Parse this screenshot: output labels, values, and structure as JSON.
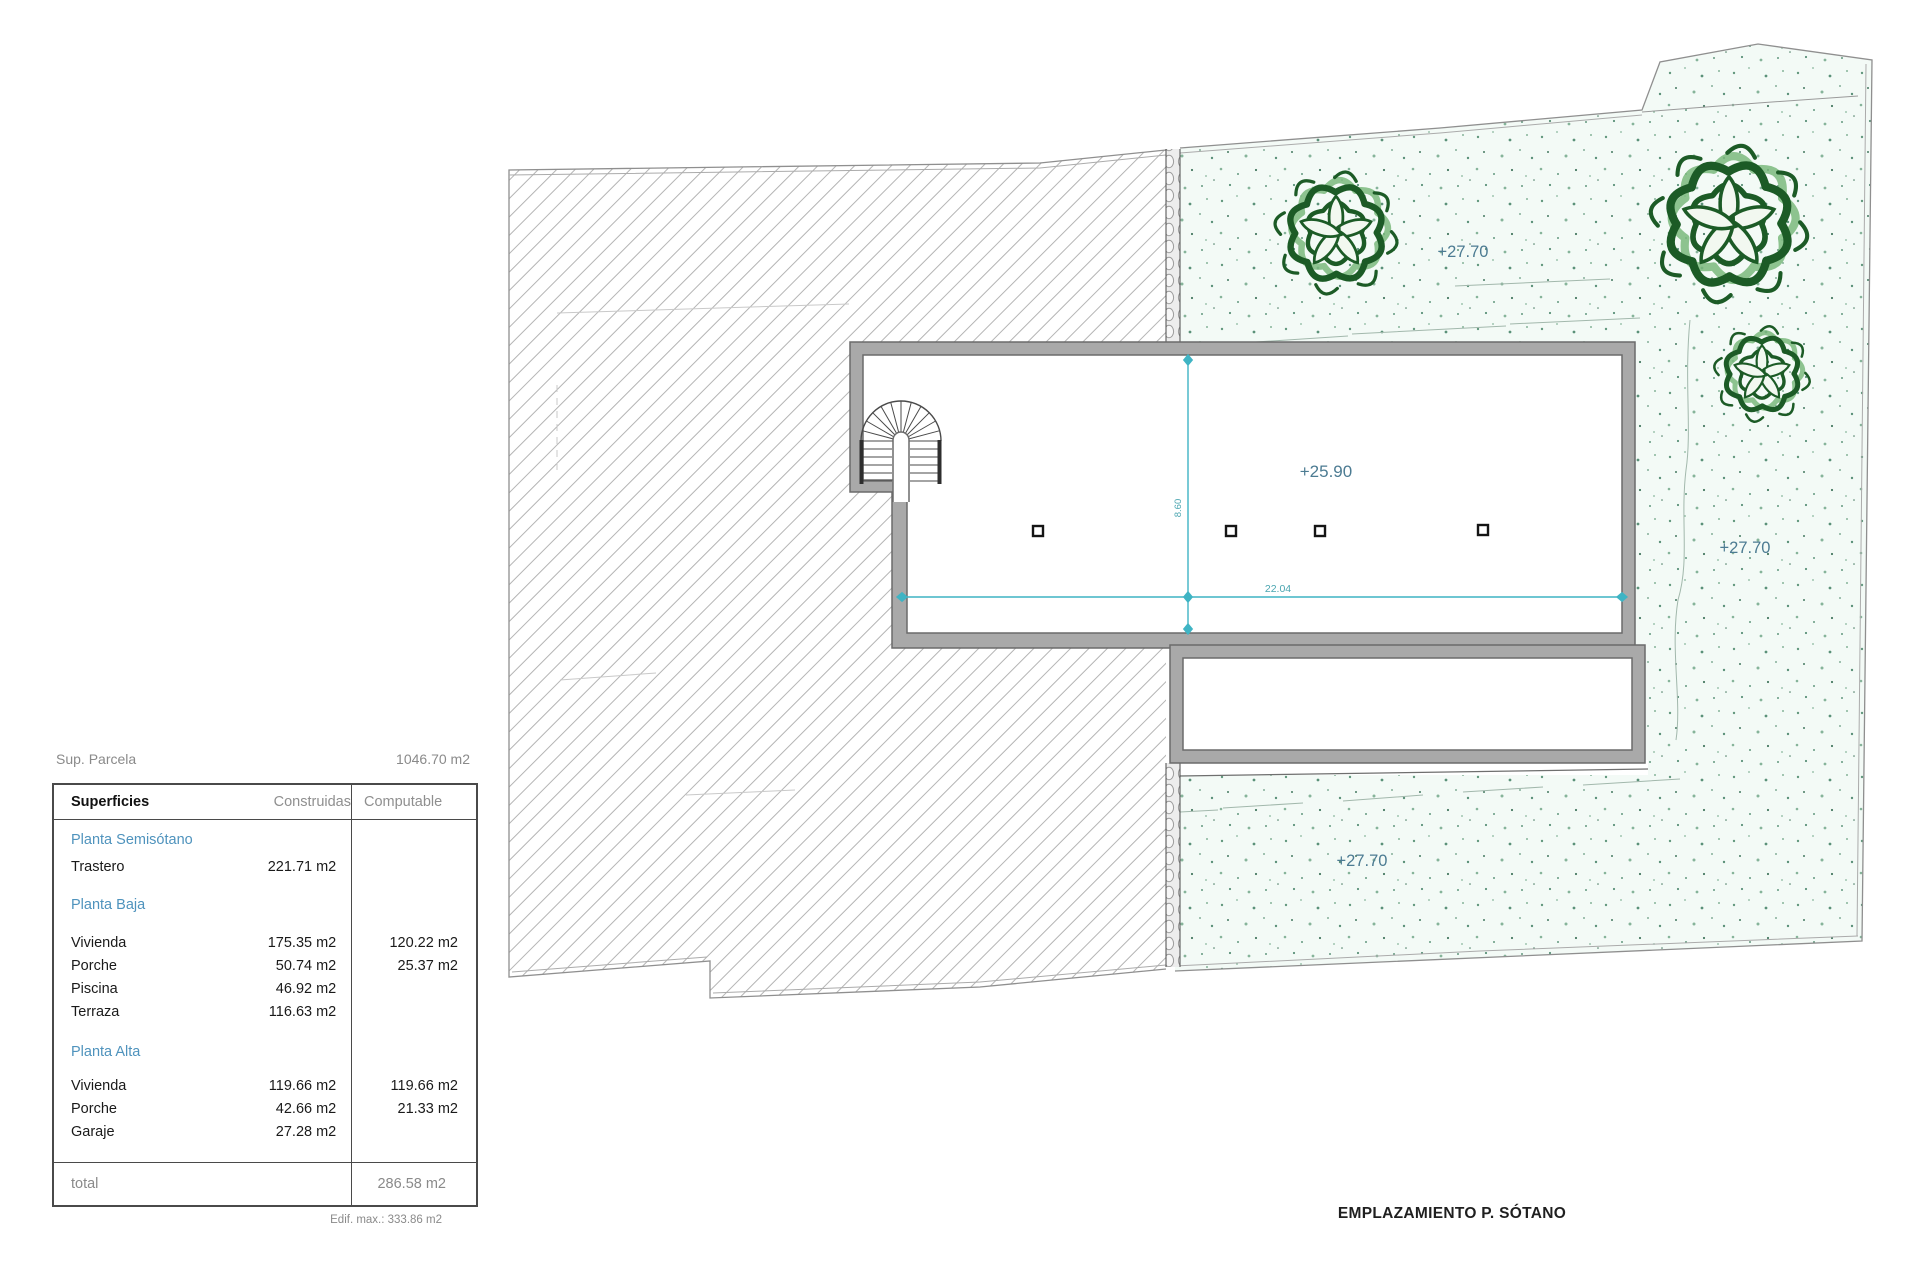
{
  "site_info": {
    "label": "Sup. Parcela",
    "value": "1046.70 m2"
  },
  "table": {
    "headers": {
      "name": "Superficies",
      "built": "Construidas",
      "computable": "Computable"
    },
    "rows": [
      {
        "type": "section",
        "name": "Planta Semisótano"
      },
      {
        "type": "data",
        "name": "Trastero",
        "built": "221.71 m2",
        "comp": ""
      },
      {
        "type": "section",
        "name": "Planta Baja"
      },
      {
        "type": "data",
        "name": "Vivienda",
        "built": "175.35 m2",
        "comp": "120.22 m2"
      },
      {
        "type": "data",
        "name": "Porche",
        "built": "50.74 m2",
        "comp": "25.37 m2"
      },
      {
        "type": "data",
        "name": "Piscina",
        "built": "46.92 m2",
        "comp": ""
      },
      {
        "type": "data",
        "name": "Terraza",
        "built": "116.63 m2",
        "comp": ""
      },
      {
        "type": "section",
        "name": "Planta Alta"
      },
      {
        "type": "data",
        "name": "Vivienda",
        "built": "119.66 m2",
        "comp": "119.66 m2"
      },
      {
        "type": "data",
        "name": "Porche",
        "built": "42.66 m2",
        "comp": "21.33 m2"
      },
      {
        "type": "data",
        "name": "Garaje",
        "built": "27.28 m2",
        "comp": ""
      }
    ],
    "total_label": "total",
    "total_value": "286.58 m2",
    "footnote": "Edif. max.: 333.86 m2"
  },
  "plan": {
    "caption": "EMPLAZAMIENTO P. SÓTANO",
    "levels": {
      "garden_top": "+27.70",
      "garden_right": "+27.70",
      "garden_bottom": "+27.70",
      "floor": "+25.90"
    },
    "dimensions": {
      "width": "22.04",
      "depth": "8.60"
    }
  },
  "colors": {
    "accent_dim": "#3fb4c4",
    "level_label": "#4c7b92",
    "section_blue": "#4f93bd",
    "plant_green": "#1c5b26",
    "wall_grey": "#a9a9a9"
  }
}
